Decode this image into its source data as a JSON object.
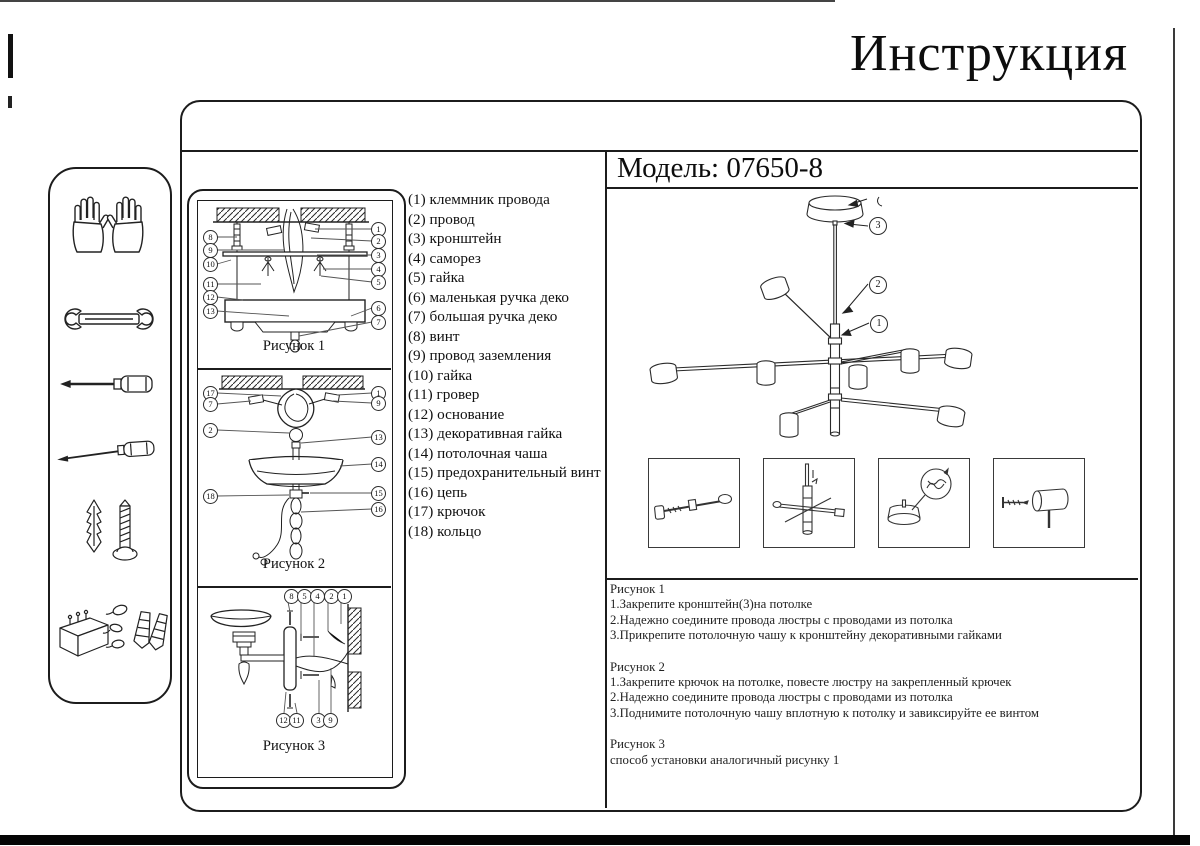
{
  "page": {
    "title": "Инструкция",
    "model": "Модель: 07650-8"
  },
  "sidebar": {
    "icons": [
      {
        "name": "gloves"
      },
      {
        "name": "wrench"
      },
      {
        "name": "flat-screwdriver"
      },
      {
        "name": "thin-screwdriver"
      },
      {
        "name": "wall-plug-and-screw"
      },
      {
        "name": "fasteners-kit"
      }
    ]
  },
  "parts_list": [
    "(1) клеммник провода",
    "(2) провод",
    "(3) кронштейн",
    "(4) саморез",
    "(5) гайка",
    "(6) маленькая ручка деко",
    "(7) большая ручка деко",
    "(8) винт",
    "(9) провод заземления",
    "(10) гайка",
    "(11) гровер",
    "(12) основание",
    "(13) декоративная гайка",
    "(14) потолочная чаша",
    "(15) предохранительный винт",
    "(16) цепь",
    "(17) крючок",
    "(18) кольцо"
  ],
  "figures": [
    {
      "caption": "Рисунок 1",
      "left": [
        "8",
        "9",
        "10",
        "11",
        "12",
        "13"
      ],
      "right": [
        "1",
        "2",
        "3",
        "4",
        "5",
        "6",
        "7"
      ]
    },
    {
      "caption": "Рисунок 2",
      "left": [
        "17",
        "7",
        "2",
        "18"
      ],
      "right": [
        "1",
        "9",
        "13",
        "14",
        "15",
        "16"
      ]
    },
    {
      "caption": "Рисунок 3",
      "top": [
        "8",
        "5",
        "4",
        "2",
        "1"
      ],
      "bottom": [
        "12",
        "11",
        "3",
        "9"
      ]
    }
  ],
  "diagram": {
    "callouts": [
      "3",
      "2",
      "1"
    ]
  },
  "instructions": [
    {
      "heading": "Рисунок 1",
      "steps": [
        "1.Закрепите кронштейн(3)на потолке",
        "2.Надежно соедините провода люстры с проводами из потолка",
        "3.Прикрепите потолочную чашу к кронштейну декоративными гайками"
      ]
    },
    {
      "heading": "Рисунок 2",
      "steps": [
        "1.Закрепите крючок на потолке, повесте люстру на закрепленный крючек",
        "2.Надежно соедините провода люстры с проводами из потолка",
        "3.Поднимите потолочную чашу вплотную к потолку и завиксируйте ее винтом"
      ]
    },
    {
      "heading": "Рисунок 3",
      "steps": [
        "способ установки аналогичный рисунку 1"
      ]
    }
  ]
}
